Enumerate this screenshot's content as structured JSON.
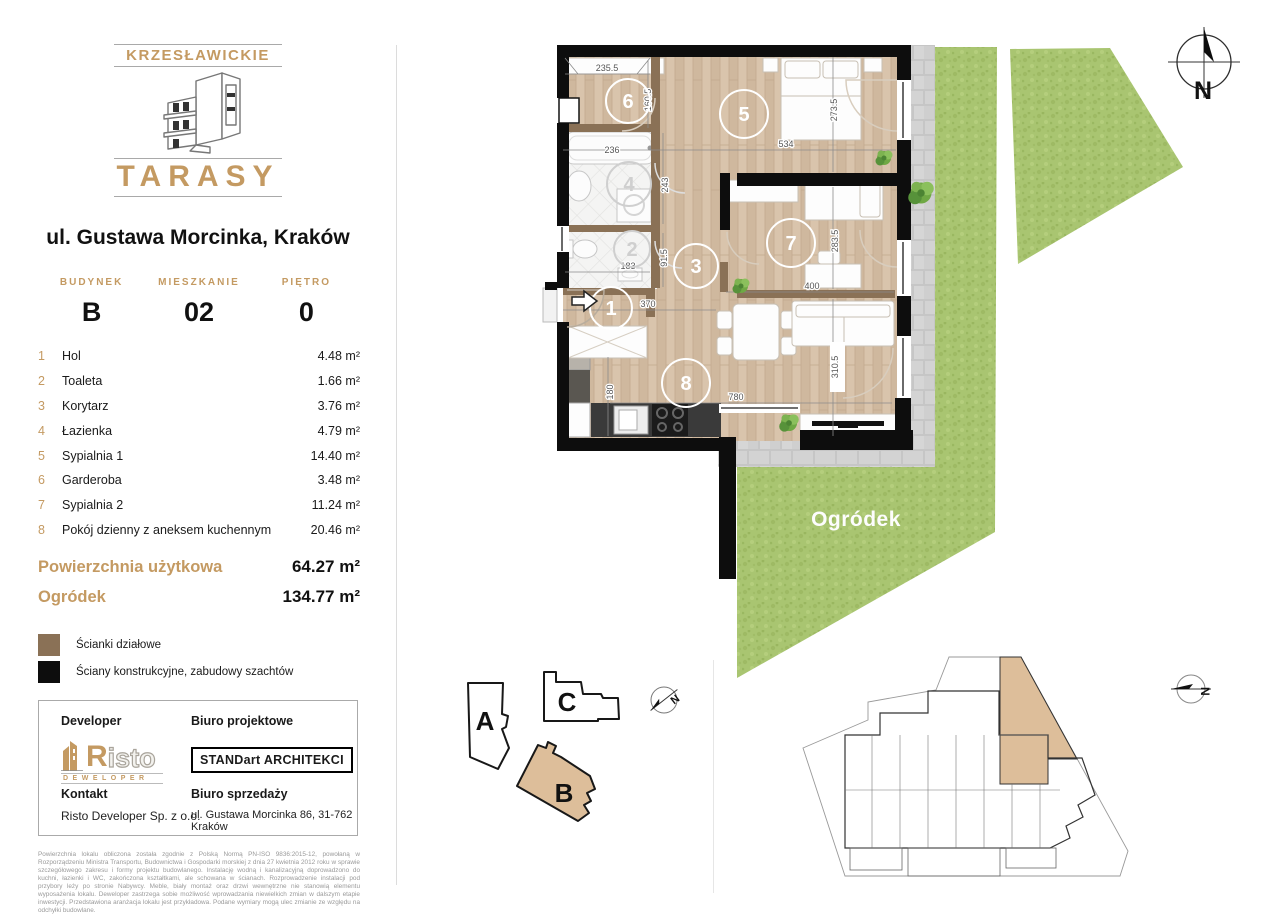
{
  "logo": {
    "top": "KRZESŁAWICKIE",
    "bottom": "TARASY"
  },
  "address": "ul. Gustawa Morcinka, Kraków",
  "info": {
    "columns": [
      {
        "label": "BUDYNEK",
        "value": "B"
      },
      {
        "label": "MIESZKANIE",
        "value": "02"
      },
      {
        "label": "PIĘTRO",
        "value": "0"
      }
    ]
  },
  "rooms": [
    {
      "no": "1",
      "name": "Hol",
      "area": "4.48 m²"
    },
    {
      "no": "2",
      "name": "Toaleta",
      "area": "1.66 m²"
    },
    {
      "no": "3",
      "name": "Korytarz",
      "area": "3.76 m²"
    },
    {
      "no": "4",
      "name": "Łazienka",
      "area": "4.79 m²"
    },
    {
      "no": "5",
      "name": "Sypialnia 1",
      "area": "14.40 m²"
    },
    {
      "no": "6",
      "name": "Garderoba",
      "area": "3.48 m²"
    },
    {
      "no": "7",
      "name": "Sypialnia 2",
      "area": "11.24 m²"
    },
    {
      "no": "8",
      "name": "Pokój dzienny z aneksem kuchennym",
      "area": "20.46 m²"
    }
  ],
  "totals": [
    {
      "label": "Powierzchnia użytkowa",
      "value": "64.27 m²"
    },
    {
      "label": "Ogródek",
      "value": "134.77 m²"
    }
  ],
  "legend": [
    {
      "label": "Ścianki działowe",
      "color": "#8A7156"
    },
    {
      "label": "Ściany konstrukcyjne, zabudowy szachtów",
      "color": "#0D0D0D"
    }
  ],
  "developer_box": {
    "developer_label": "Developer",
    "risto_r": "R",
    "risto_rest": "isto",
    "risto_sub": "DEWELOPER",
    "biuro_projektowe_label": "Biuro projektowe",
    "biuro_projektowe_name": "STANDart ARCHITEKCI",
    "kontakt_label": "Kontakt",
    "kontakt_value": "Risto Developer Sp. z o.o.",
    "biuro_sprzedazy_label": "Biuro sprzedaży",
    "biuro_sprzedazy_value": "ul. Gustawa Morcinka 86, 31-762 Kraków"
  },
  "disclaimer": "Powierzchnia lokalu obliczona została zgodnie z Polską Normą PN-ISO 9836:2015-12, powołaną w Rozporządzeniu Ministra Transportu, Budownictwa i Gospodarki morskiej z dnia 27 kwietnia 2012 roku w sprawie szczegółowego zakresu i formy projektu budowlanego. Instalację wodną i kanalizacyjną doprowadzono do kuchni, łazienki i WC, zakończona kształtkami, ale schowana w ścianach. Rozprowadzenie instalacji pod przybory leży po stronie Nabywcy. Meble, biały montaż oraz drzwi wewnętrzne nie stanowią elementu wyposażenia lokalu. Deweloper zastrzega sobie możliwość wprowadzania niewielkich zmian w dalszym etapie inwestycji. Przedstawiona aranżacja lokalu jest przykładowa. Podane wymiary mogą ulec zmianie ze względu na odchyłki budowlane.",
  "plan": {
    "garden_label": "Ogródek",
    "north": "N",
    "room_numbers": [
      "1",
      "2",
      "3",
      "4",
      "5",
      "6",
      "7",
      "8"
    ],
    "dimensions": [
      {
        "value": "235.5"
      },
      {
        "value": "160.5"
      },
      {
        "value": "236"
      },
      {
        "value": "243"
      },
      {
        "value": "534"
      },
      {
        "value": "273.5"
      },
      {
        "value": "183"
      },
      {
        "value": "91.5"
      },
      {
        "value": "283.5"
      },
      {
        "value": "370"
      },
      {
        "value": "400"
      },
      {
        "value": "310.5"
      },
      {
        "value": "180"
      },
      {
        "value": "780"
      }
    ]
  },
  "site": {
    "buildings": [
      {
        "label": "A"
      },
      {
        "label": "C"
      },
      {
        "label": "B"
      }
    ]
  },
  "colors": {
    "gold": "#C49A62",
    "partition_wall": "#8A7156",
    "structural_wall": "#0D0D0D",
    "grass": "#A9C571",
    "wood_floor": "#D5BFA6",
    "highlight_unit": "#DDBE9A",
    "paving": "#CDCDCD"
  }
}
